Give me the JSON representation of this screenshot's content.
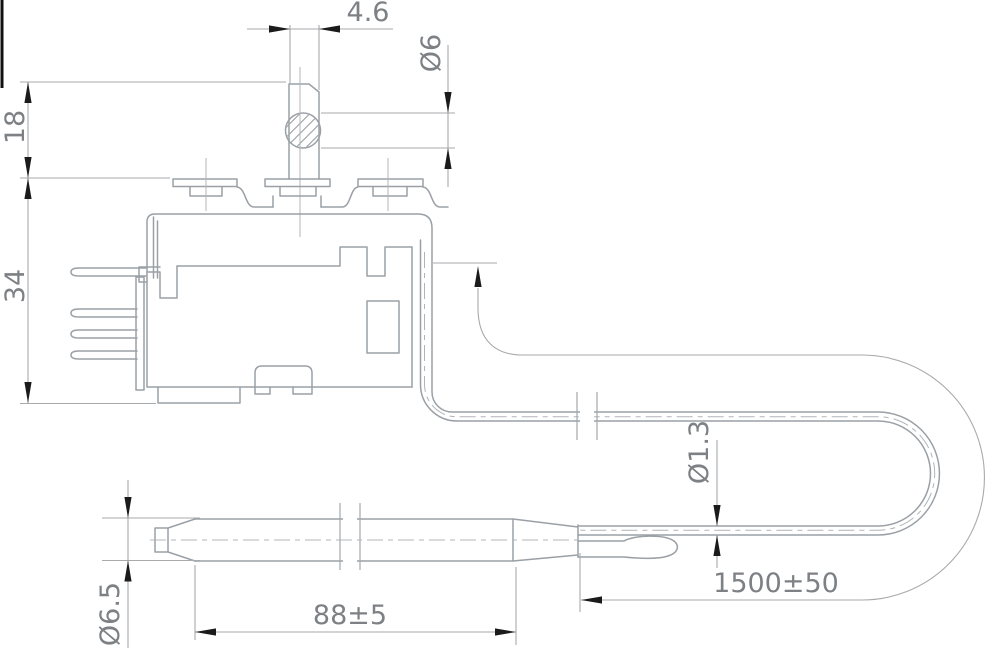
{
  "drawing": {
    "title": "Thermostat with capillary sensor - dimensioned engineering drawing",
    "type": "engineering-drawing",
    "background": "#ffffff",
    "colors": {
      "outline": "#9aa0a6",
      "dimension_line": "#a8aaac",
      "arrow": "#1b1b1b",
      "text": "#7d8084"
    },
    "dimensions": {
      "shaft_flat_width": "4.6",
      "shaft_diameter": "Ø6",
      "shaft_height": "18",
      "body_height": "34",
      "capillary_diameter": "Ø1.3",
      "bulb_diameter": "Ø6.5",
      "bulb_length": "88±5",
      "capillary_length": "1500±50"
    }
  }
}
